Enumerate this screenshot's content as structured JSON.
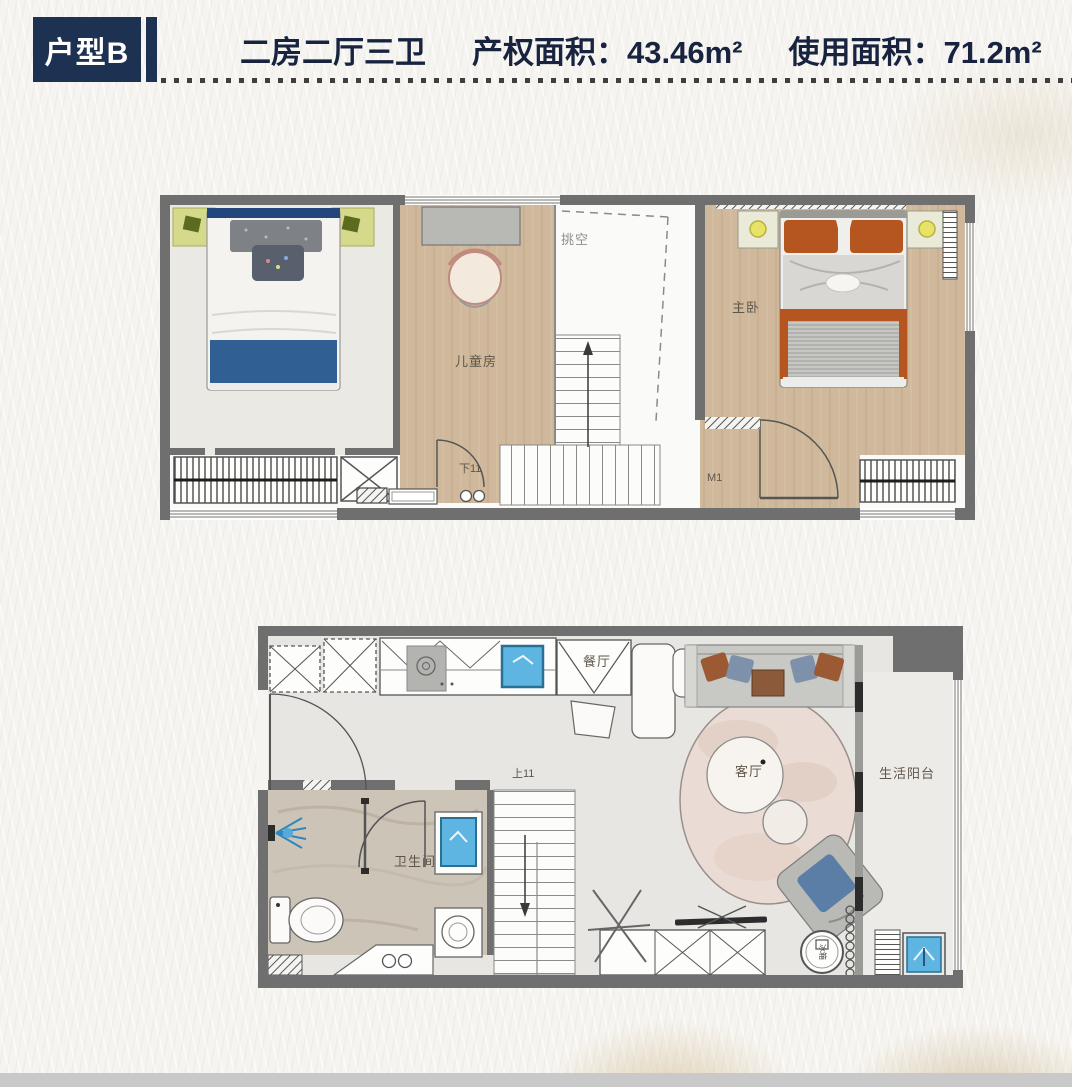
{
  "header": {
    "badge": "户型B",
    "layout_type": "二房二厅三卫",
    "property_area_label": "产权面积：",
    "property_area_value": "43.46m²",
    "usable_area_label": "使用面积：",
    "usable_area_value": "71.2m²"
  },
  "colors": {
    "accent_navy": "#1d3253",
    "wall_gray": "#6f6f6f",
    "wood_floor": "#cfb89b",
    "fixture_blue": "#5fb5e2",
    "lamp_yellow": "#e8e266",
    "blanket_blue": "#2f5f93",
    "pillow_orange": "#b55620"
  },
  "upper_floor": {
    "labels": {
      "void": "挑空",
      "kids_room": "儿童房",
      "master_bedroom": "主卧",
      "stairs_down": "下11",
      "door_mark": "M1"
    }
  },
  "lower_floor": {
    "labels": {
      "dining": "餐厅",
      "stairs_up": "上11",
      "living": "客厅",
      "balcony": "生活阳台",
      "bathroom": "卫生间",
      "fridge": "冰箱"
    }
  }
}
